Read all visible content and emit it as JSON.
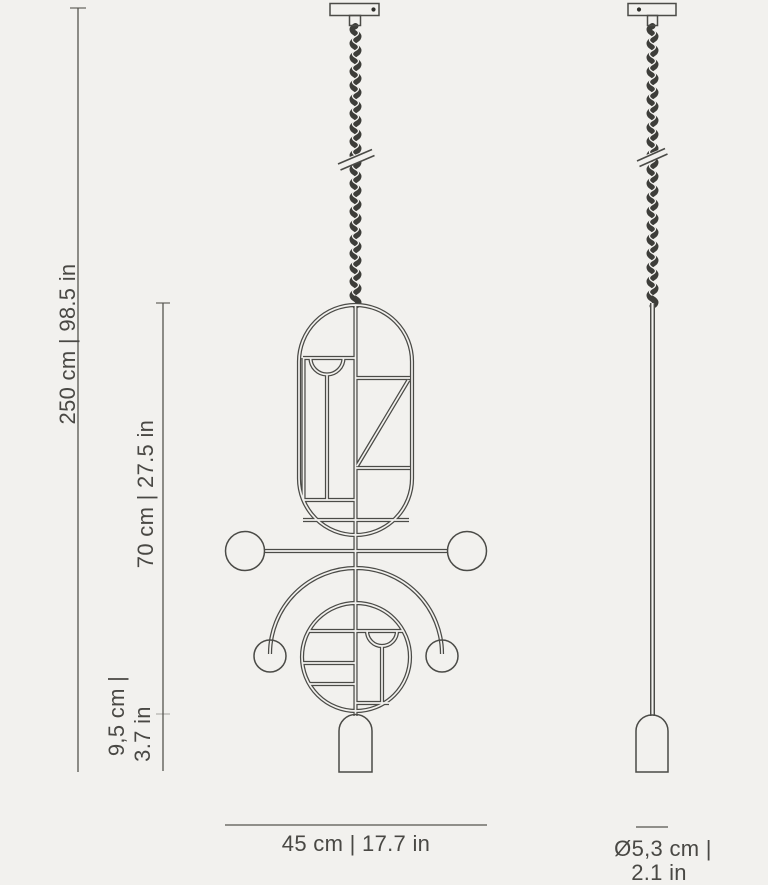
{
  "colors": {
    "background": "#f2f1ee",
    "line": "#4b4b47",
    "cord": "#3d3d39",
    "text": "#494844"
  },
  "dimensions": {
    "overall_height": {
      "label": "250 cm | 98.5 in"
    },
    "body_height": {
      "label": "70 cm | 27.5 in"
    },
    "shade_height": {
      "line1": "9,5 cm |",
      "line2": "3.7 in"
    },
    "width": {
      "label": "45 cm | 17.7 in"
    },
    "shade_diameter": {
      "line1": "Ø5,3 cm |",
      "line2": "2.1 in"
    }
  }
}
